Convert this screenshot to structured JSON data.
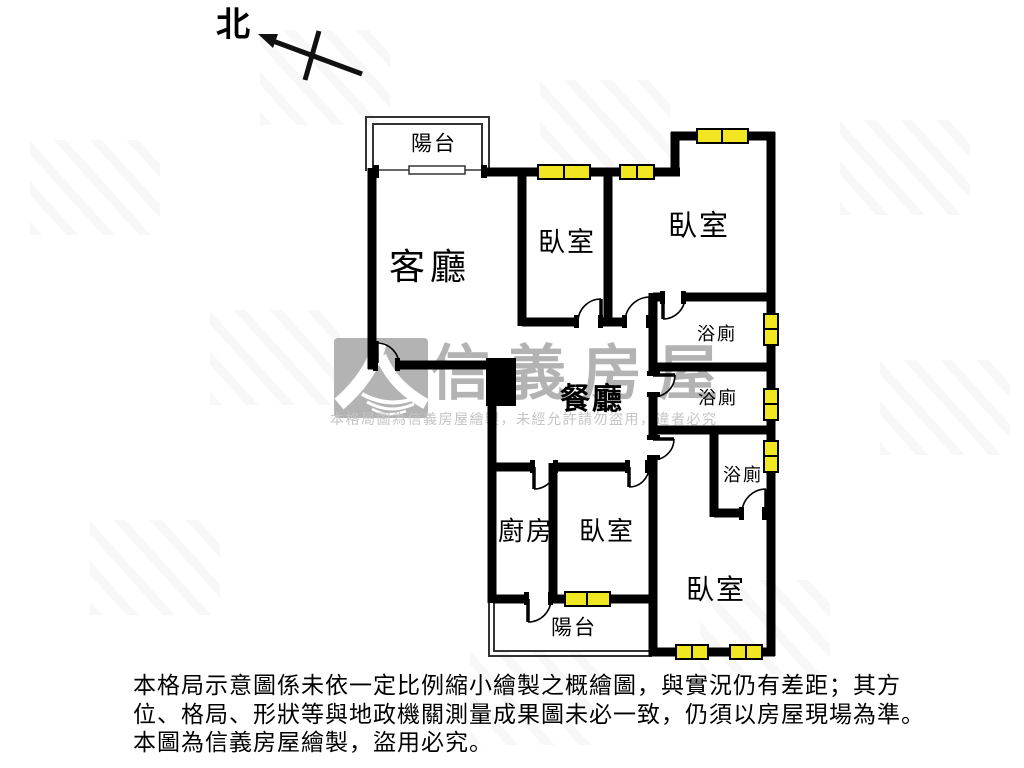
{
  "compass": {
    "north_label": "北"
  },
  "rooms": {
    "balcony_top": {
      "label": "陽台"
    },
    "living": {
      "label": "客廳"
    },
    "bedroom_top_mid": {
      "label": "臥室"
    },
    "bedroom_top_right": {
      "label": "臥室"
    },
    "bath1": {
      "label": "浴廁"
    },
    "bath2": {
      "label": "浴廁"
    },
    "bath3": {
      "label": "浴廁"
    },
    "dining": {
      "label": "餐廳"
    },
    "kitchen": {
      "label": "廚房"
    },
    "bedroom_bottom_mid": {
      "label": "臥室"
    },
    "bedroom_bottom_right": {
      "label": "臥室"
    },
    "balcony_bottom": {
      "label": "陽台"
    }
  },
  "watermark": {
    "brand": "信義房屋",
    "notice": "本格局圖為信義房屋繪製，未經允許請勿盜用，違者必究"
  },
  "disclaimer": {
    "line1": "本格局示意圖係未依一定比例縮小繪製之概繪圖，與實況仍有差距；其方",
    "line2": "位、格局、形狀等與地政機關測量成果圖未必一致，仍須以房屋現場為準。",
    "line3": "本圖為信義房屋繪製，盜用必究。"
  },
  "colors": {
    "wall": "#000000",
    "window_fill": "#f0e622",
    "watermark_gray": "#b3b3b3"
  }
}
